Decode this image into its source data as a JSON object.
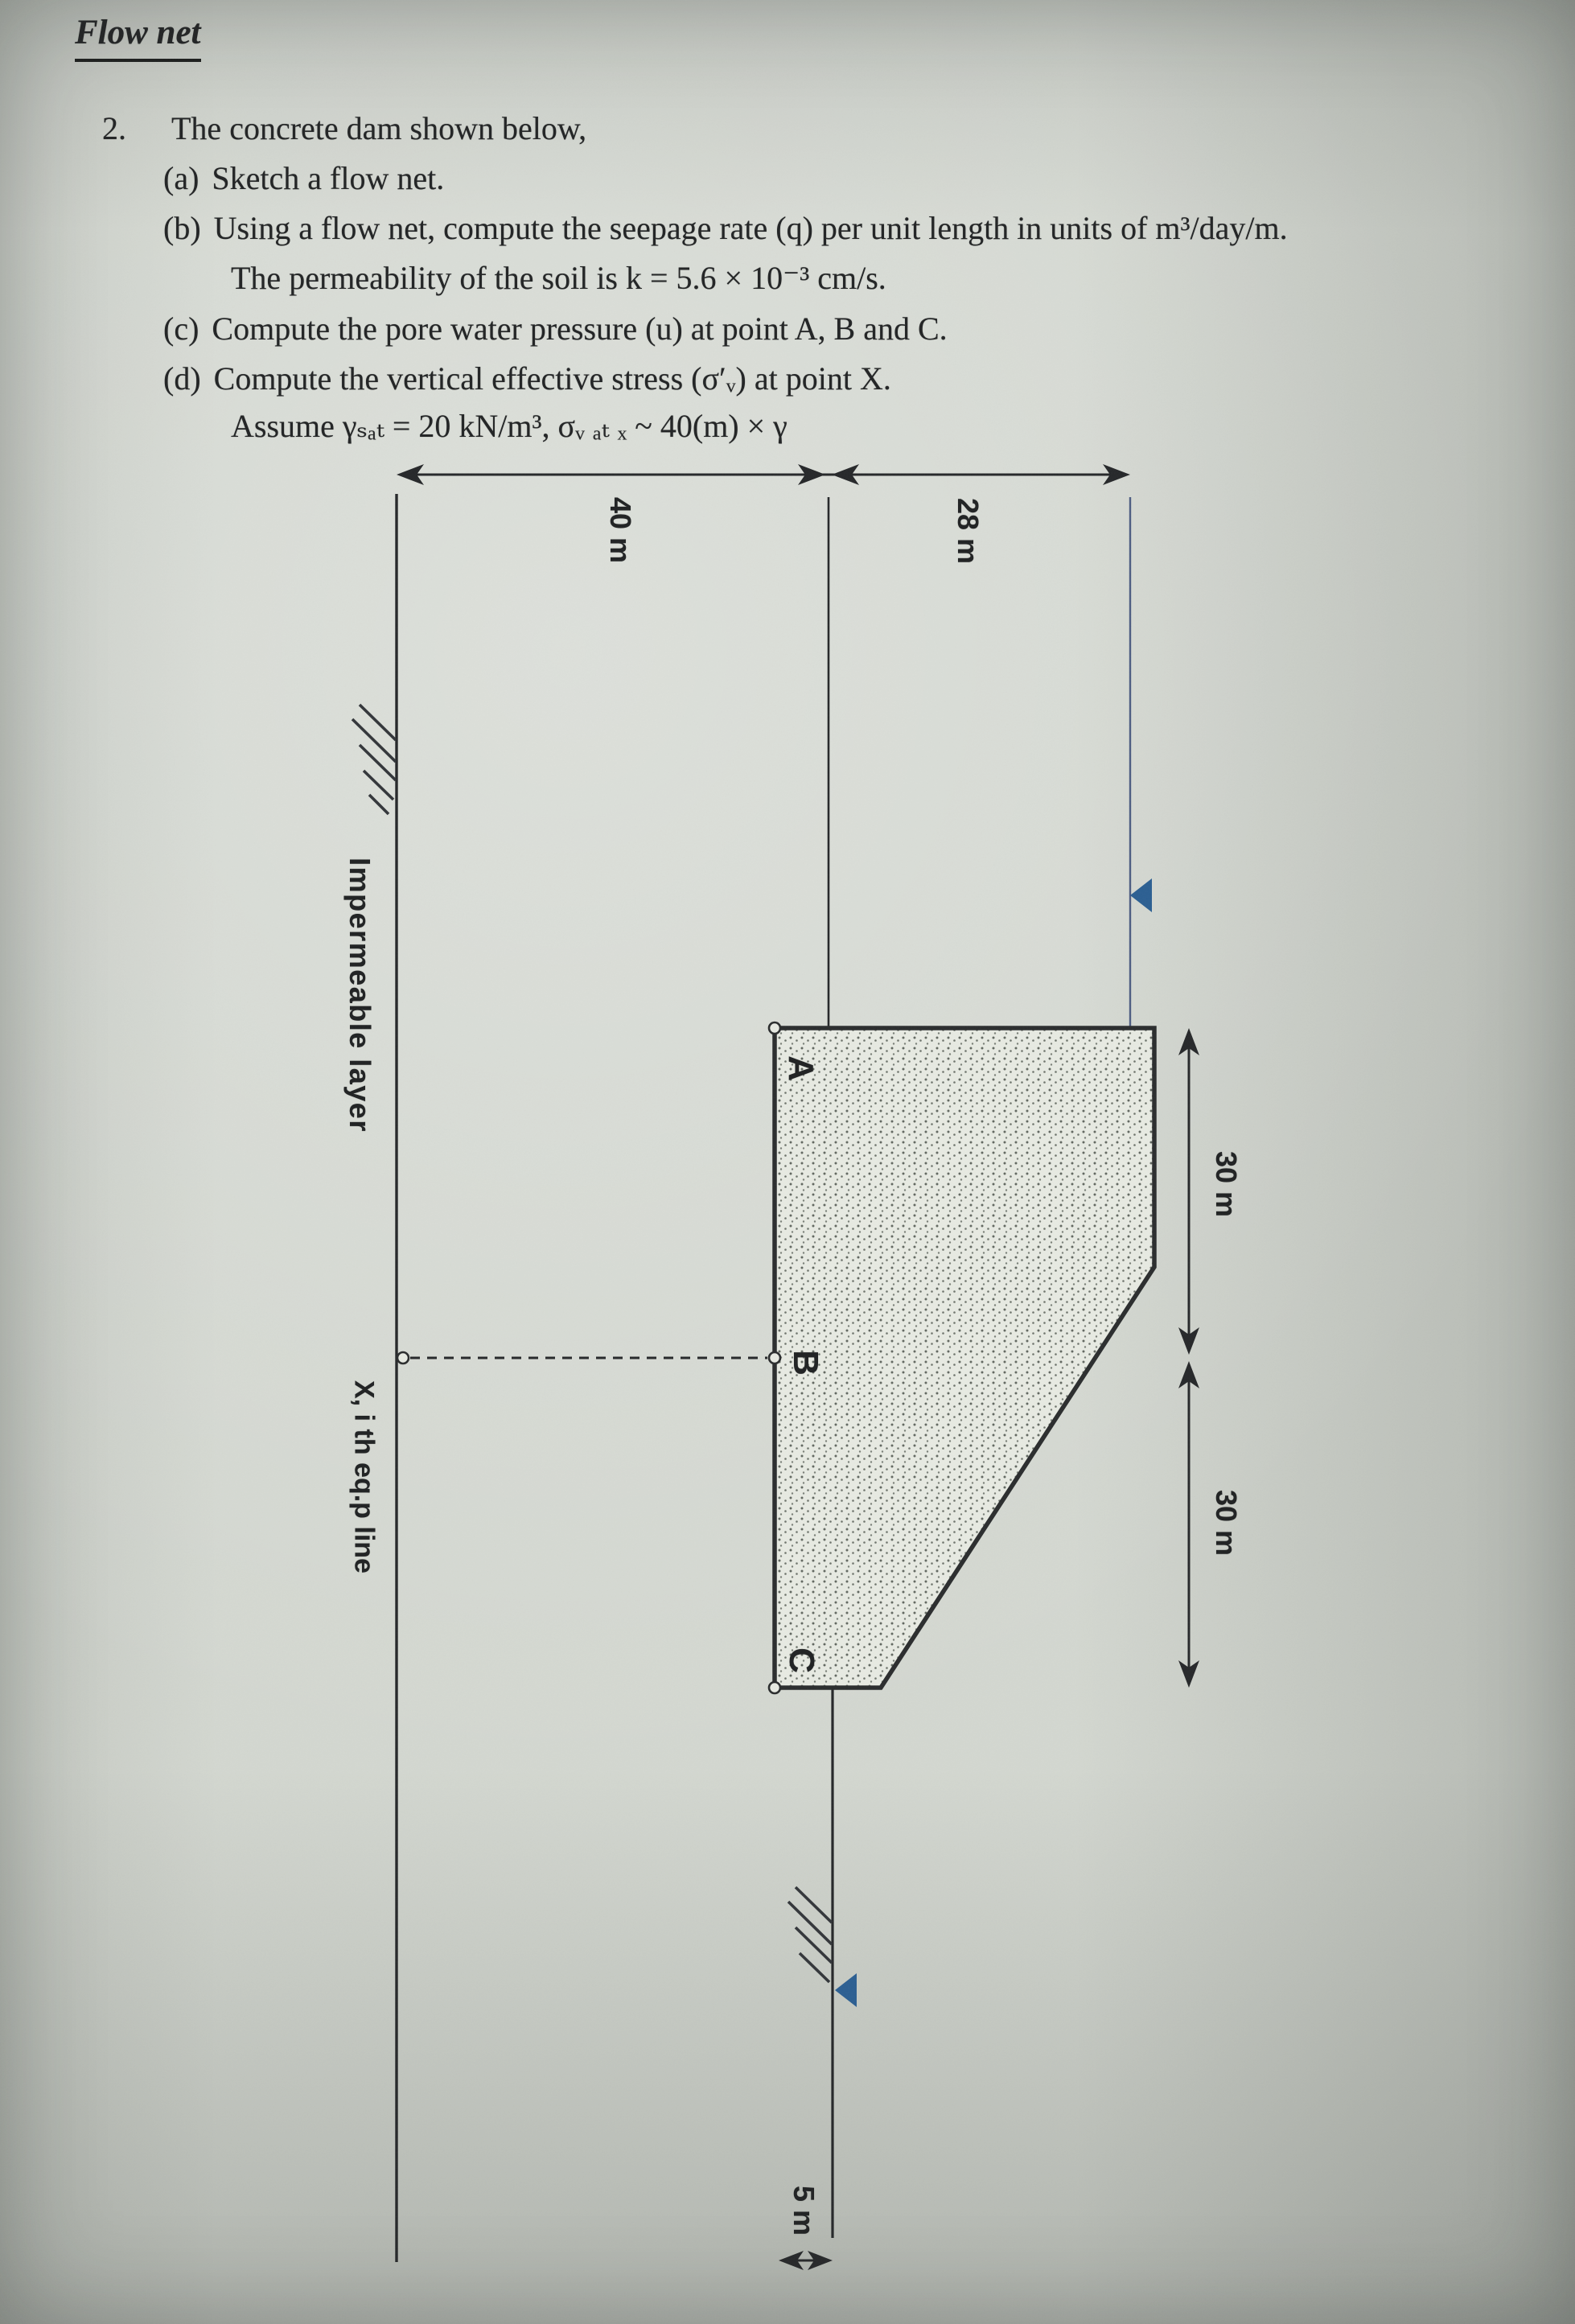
{
  "page": {
    "title": "Flow net",
    "problem": {
      "number": "2.",
      "intro": "The concrete dam shown below,",
      "item_a_label": "(a)",
      "item_a": "Sketch a flow net.",
      "item_b_label": "(b)",
      "item_b": "Using a flow net, compute the seepage rate (q) per unit length in units of m³/day/m.",
      "item_b2": "The permeability of the soil is k = 5.6 × 10⁻³ cm/s.",
      "item_c_label": "(c)",
      "item_c": "Compute the pore water pressure (u) at point A, B and C.",
      "item_d_label": "(d)",
      "item_d": "Compute the vertical effective stress (σ′ᵥ) at point X.",
      "item_d2": "Assume γₛₐₜ = 20 kN/m³, σᵥ ₐₜ ₓ ~ 40(m) × γ"
    },
    "diagram": {
      "dim_40": "40 m",
      "dim_28": "28 m",
      "dim_30_upper": "30 m",
      "dim_30_lower": "30 m",
      "dim_5": "5 m",
      "point_a": "A",
      "point_b": "B",
      "point_c": "C",
      "label_impermeable": "Impermeable layer",
      "label_eqp": "X, i th eq.p line",
      "colors": {
        "water_marker": "#2c5f92",
        "water_line": "#4d5d82",
        "ink": "#26282a",
        "paper": "#d3d7d0"
      }
    }
  }
}
